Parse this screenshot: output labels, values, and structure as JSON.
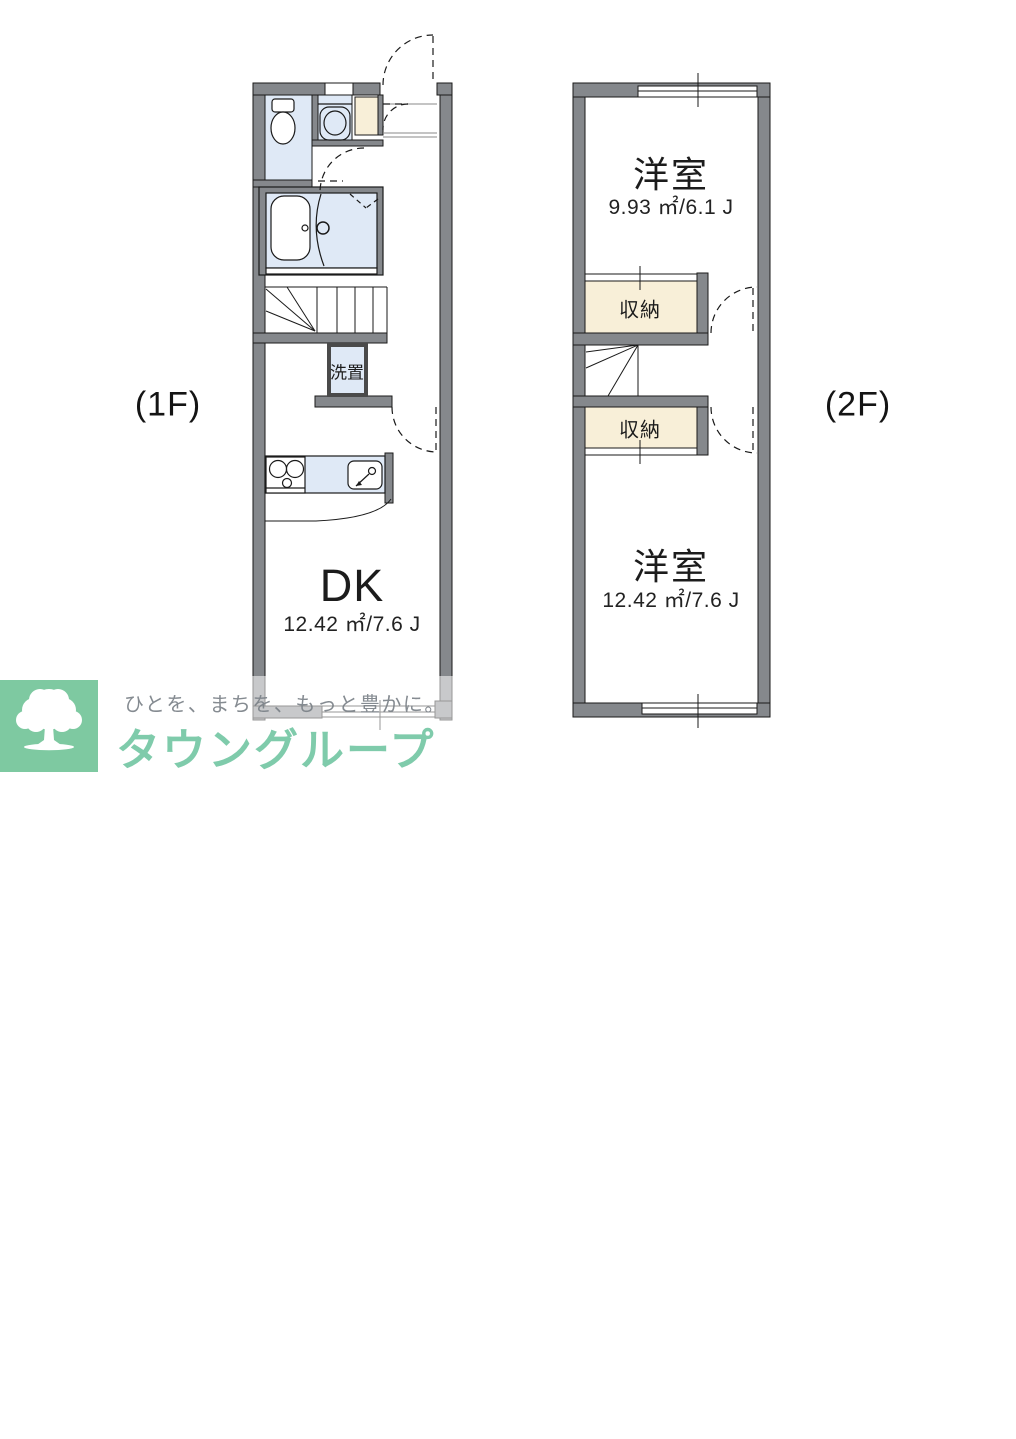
{
  "floor1": {
    "label": "(1F)",
    "dk": {
      "name": "DK",
      "area": "12.42 ㎡/7.6 J"
    },
    "laundry_label": "洗置"
  },
  "floor2": {
    "label": "(2F)",
    "room_upper": {
      "name": "洋室",
      "area": "9.93 ㎡/6.1 J"
    },
    "storage_upper": "収納",
    "storage_lower": "収納",
    "room_lower": {
      "name": "洋室",
      "area": "12.42 ㎡/7.6 J"
    }
  },
  "branding": {
    "company_en": "TOWN GROUP",
    "company_ja": "タウングループ",
    "tagline": "ひとを、まちを、もっと豊かに。",
    "brand_green": "#7ec9a1",
    "tagline_gray": "#7b8188"
  },
  "palette": {
    "wall_gray": "#85888c",
    "room_blue": "#dfe9f6",
    "storage_cream": "#f8efd8",
    "line_black": "#1a1a1a",
    "background": "#ffffff"
  }
}
